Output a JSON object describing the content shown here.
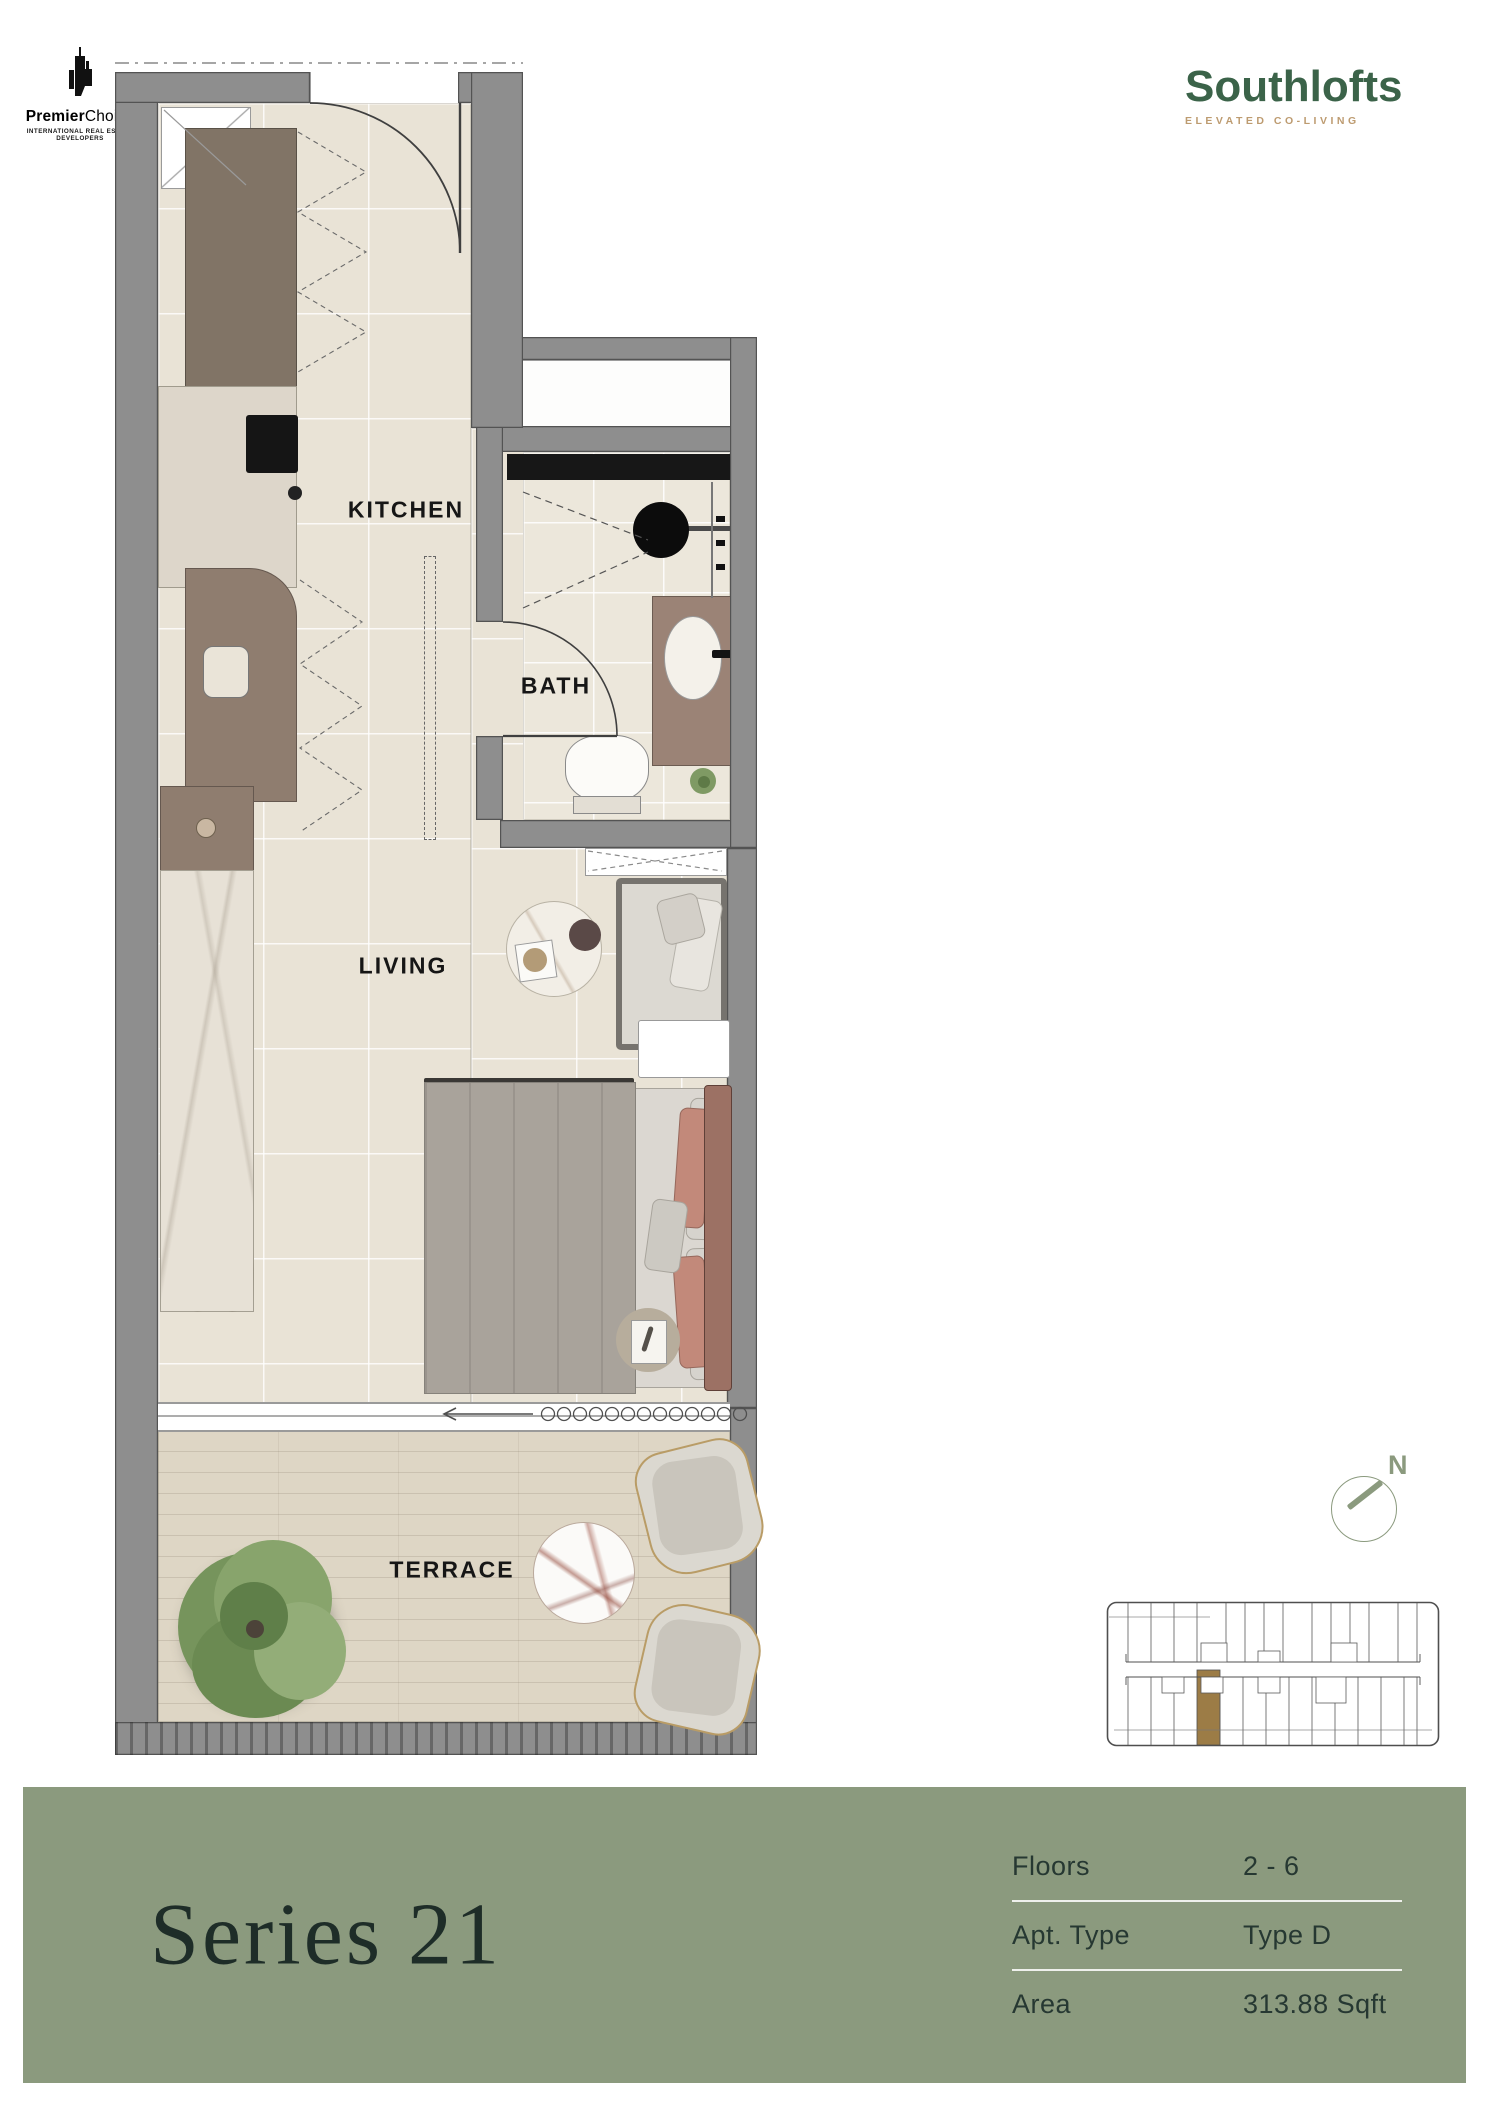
{
  "branding": {
    "premier_choice": {
      "name_bold": "Premier",
      "name_rest": "Choice",
      "tagline": "INTERNATIONAL REAL ESTATE DEVELOPERS"
    },
    "southlofts": {
      "name": "Southlofts",
      "tagline": "ELEVATED CO-LIVING"
    }
  },
  "floorplan": {
    "labels": {
      "kitchen": "KITCHEN",
      "bath": "BATH",
      "living": "LIVING",
      "terrace": "TERRACE"
    }
  },
  "compass": {
    "north_label": "N"
  },
  "banner": {
    "title": "Series 21"
  },
  "details": {
    "rows": [
      {
        "label": "Floors",
        "value": "2 - 6"
      },
      {
        "label": "Apt. Type",
        "value": "Type D"
      },
      {
        "label": "Area",
        "value": "313.88 Sqft"
      }
    ]
  },
  "colors": {
    "banner_bg": "#8b9a7e",
    "brand_green": "#3b6349",
    "brand_tan": "#bd9b70",
    "accent_gold": "#9c7c46",
    "sage_accent": "#8b9a7e",
    "wall_gray": "#8e8e8e"
  }
}
